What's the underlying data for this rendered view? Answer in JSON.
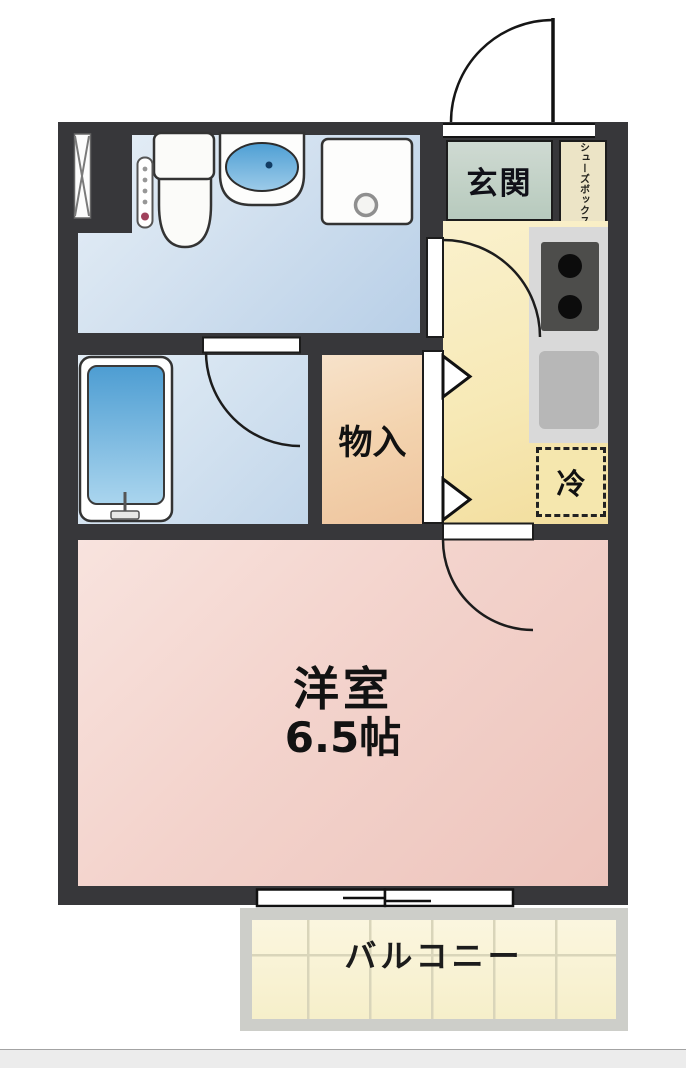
{
  "floorplan": {
    "rooms": {
      "entrance": {
        "label": "玄関"
      },
      "shoe_box": {
        "label": "シューズボックス"
      },
      "refrigerator": {
        "label": "冷"
      },
      "storage": {
        "label": "物入"
      },
      "western_room": {
        "label": "洋室",
        "size": "6.5帖"
      },
      "balcony": {
        "label": "バルコニー"
      }
    },
    "colors": {
      "wall": "#37373a",
      "washroom": "#cfe0ef",
      "bathroom": "#d3e2f0",
      "kitchen": "#f7e9b6",
      "entrance": "#c3d1c8",
      "shoe_box": "#ece4c6",
      "storage": "#f3d3ae",
      "western_room": "#f3d3cc",
      "balcony": "#f6efca",
      "refrigerator_space": "#f5e7ae",
      "kitchen_counter": "#d9d9d9",
      "stove": "#4d4d4b",
      "bathtub": "#74b0dc"
    }
  }
}
